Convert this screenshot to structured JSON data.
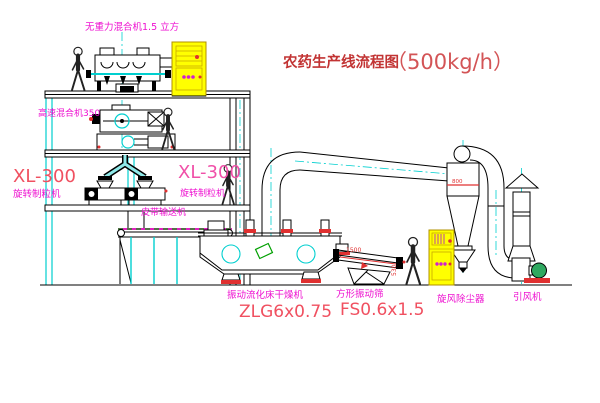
{
  "title": {
    "main": "农药生产线流程图",
    "capacity": "（500kg/h）"
  },
  "labels": {
    "gravity_mixer": "无重力混合机1.5 立方",
    "high_speed_mixer": "高速混合机350",
    "granulator_left_model": "XL-300",
    "granulator_left_name": "旋转制粒机",
    "granulator_right_model": "XL-300",
    "granulator_right_name": "旋转制粒机",
    "belt_conveyor": "皮带输送机",
    "dryer_name": "振动流化床干燥机",
    "dryer_model": "ZLG6x0.75",
    "screen_name": "方形振动筛",
    "screen_model": "FS0.6x1.5",
    "cyclone_name": "旋风除尘器",
    "fan_name": "引风机"
  },
  "dimensions": {
    "screen_length": "1500",
    "screen_height": "530",
    "cyclone_diameter": "800"
  },
  "colors": {
    "label_magenta": "#ee10d0",
    "title_red": "#c23434",
    "model_red": "#f05060",
    "accent_red": "#e03030",
    "cabinet_yellow": "#ffff00",
    "line_cyan": "#00cfcf",
    "conveyor_green": "#00a000",
    "drawing_black": "#000000",
    "background": "#ffffff"
  }
}
